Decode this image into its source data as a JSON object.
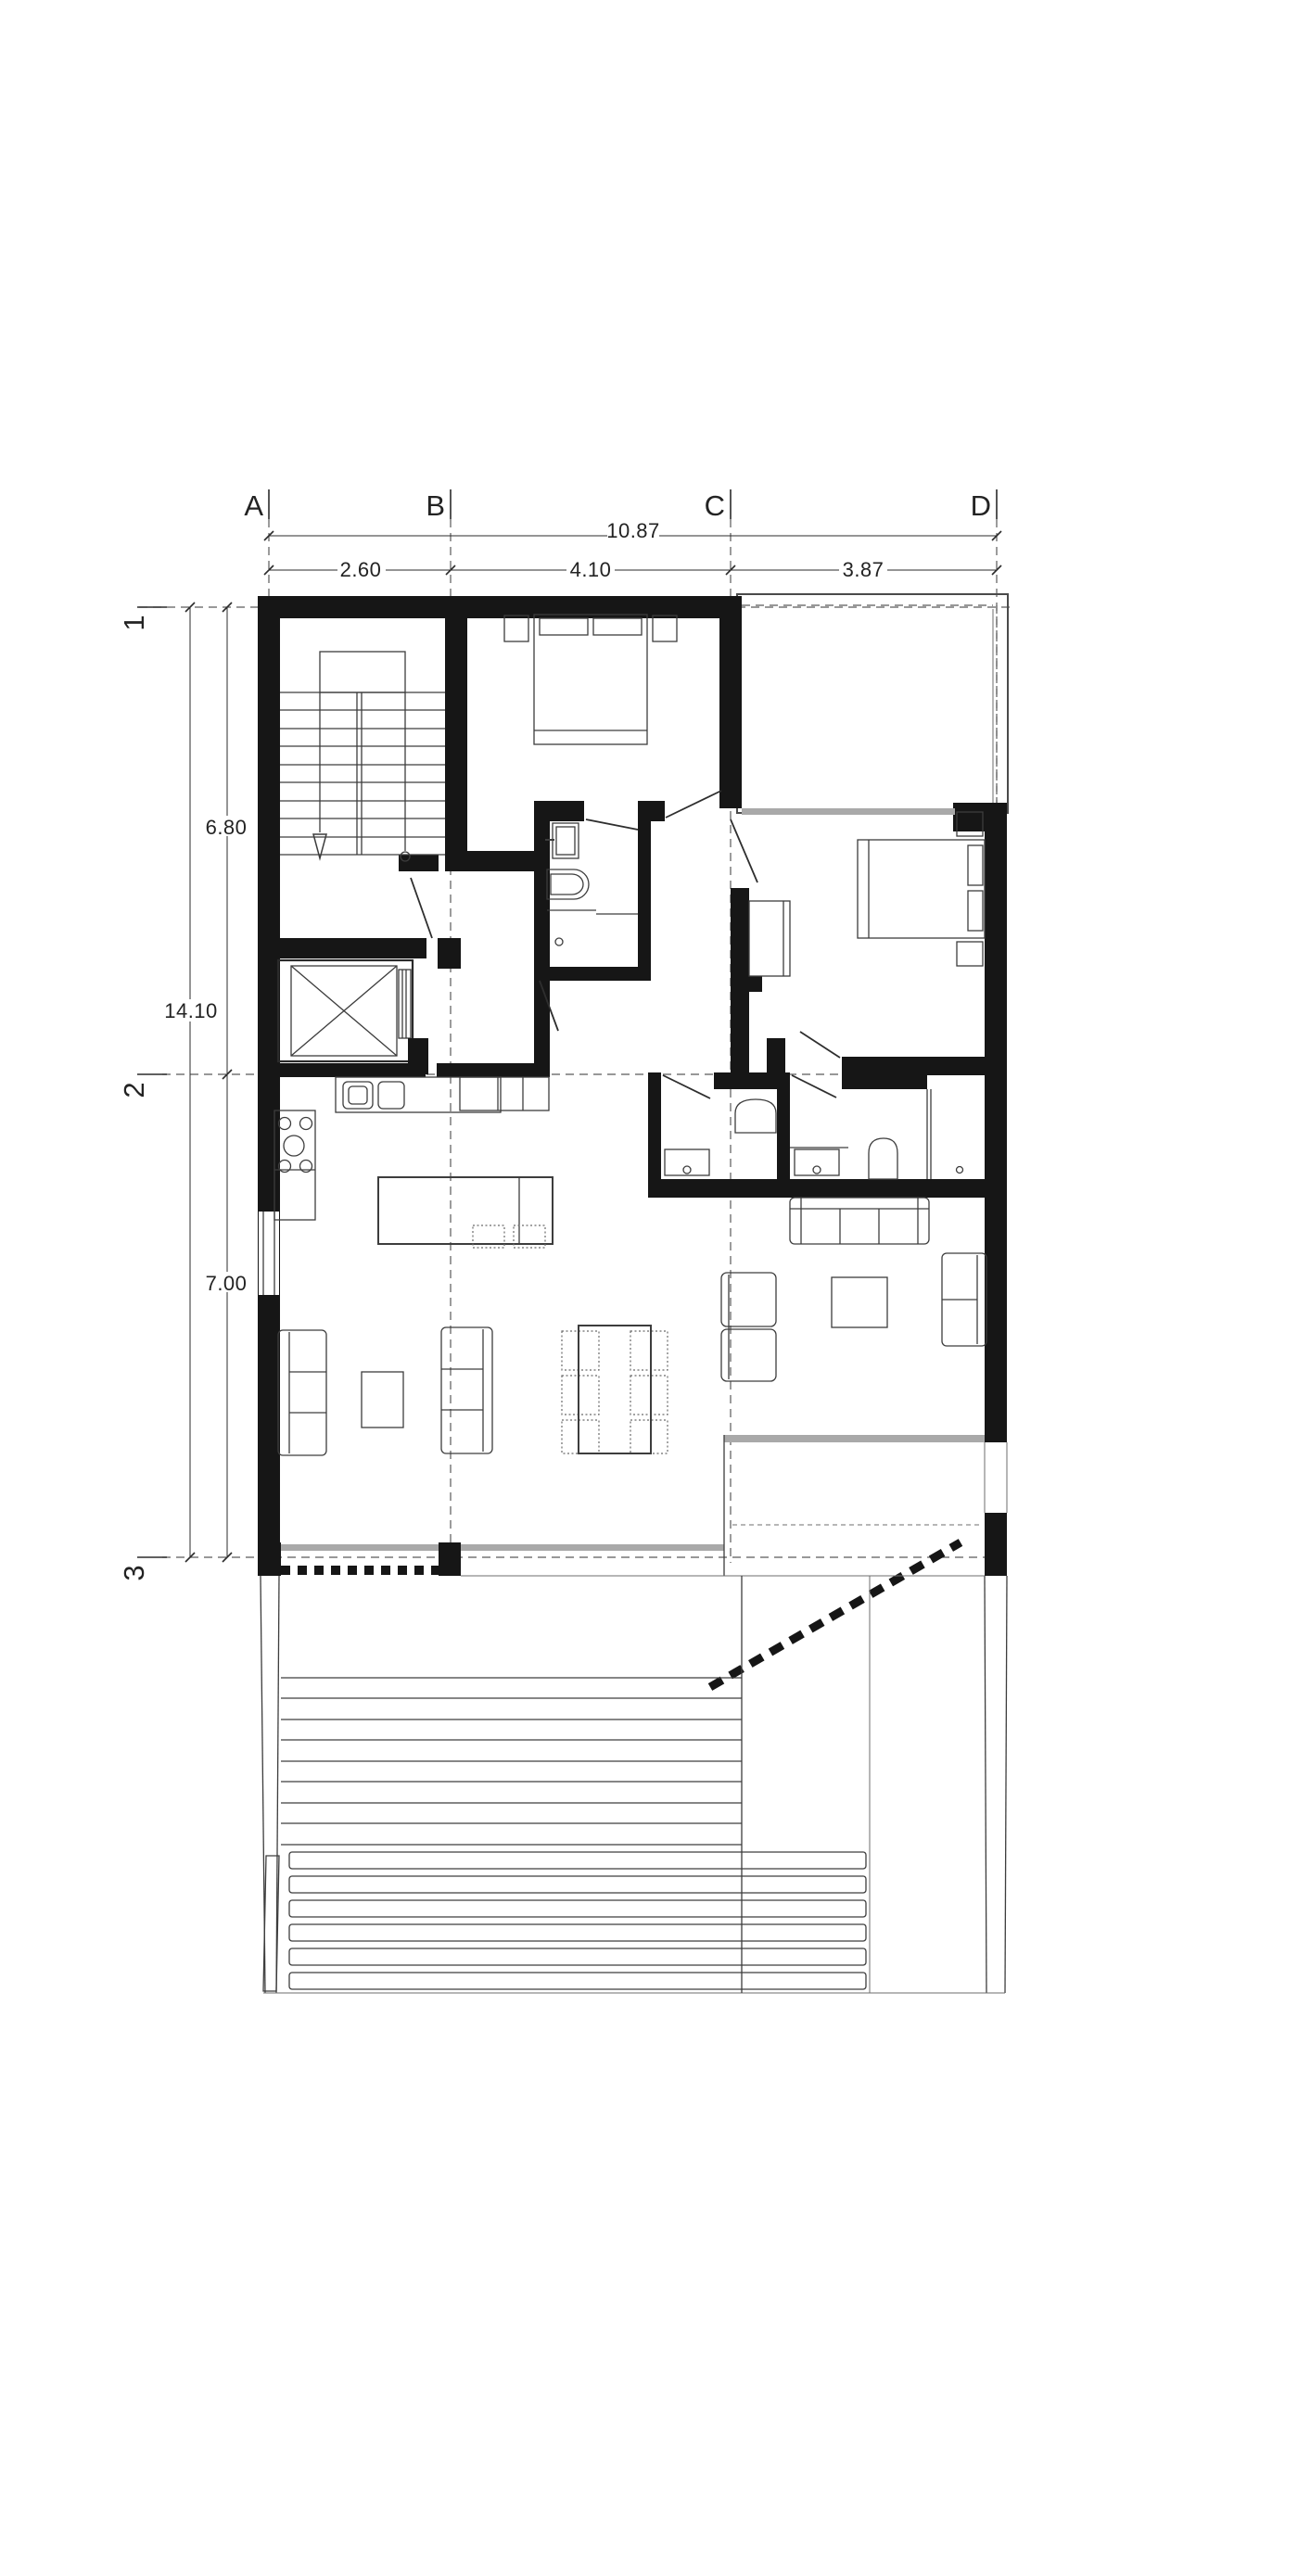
{
  "plan": {
    "grid": {
      "columns": [
        {
          "label": "A"
        },
        {
          "label": "B"
        },
        {
          "label": "C"
        },
        {
          "label": "D"
        }
      ],
      "rows": [
        {
          "label": "1"
        },
        {
          "label": "2"
        },
        {
          "label": "3"
        }
      ]
    },
    "dimensions": {
      "top": {
        "total": "10.87",
        "segments": [
          {
            "value": "2.60"
          },
          {
            "value": "4.10"
          },
          {
            "value": "3.87"
          }
        ]
      },
      "left": {
        "total": "14.10",
        "segments": [
          {
            "value": "6.80"
          },
          {
            "value": "7.00"
          }
        ]
      }
    },
    "colors": {
      "wall": "#161616",
      "line": "#3d3d3d",
      "thin": "#6e6e6e",
      "glass": "#a9a9a9",
      "dash": "#5a5a5a",
      "text": "#232323"
    }
  }
}
